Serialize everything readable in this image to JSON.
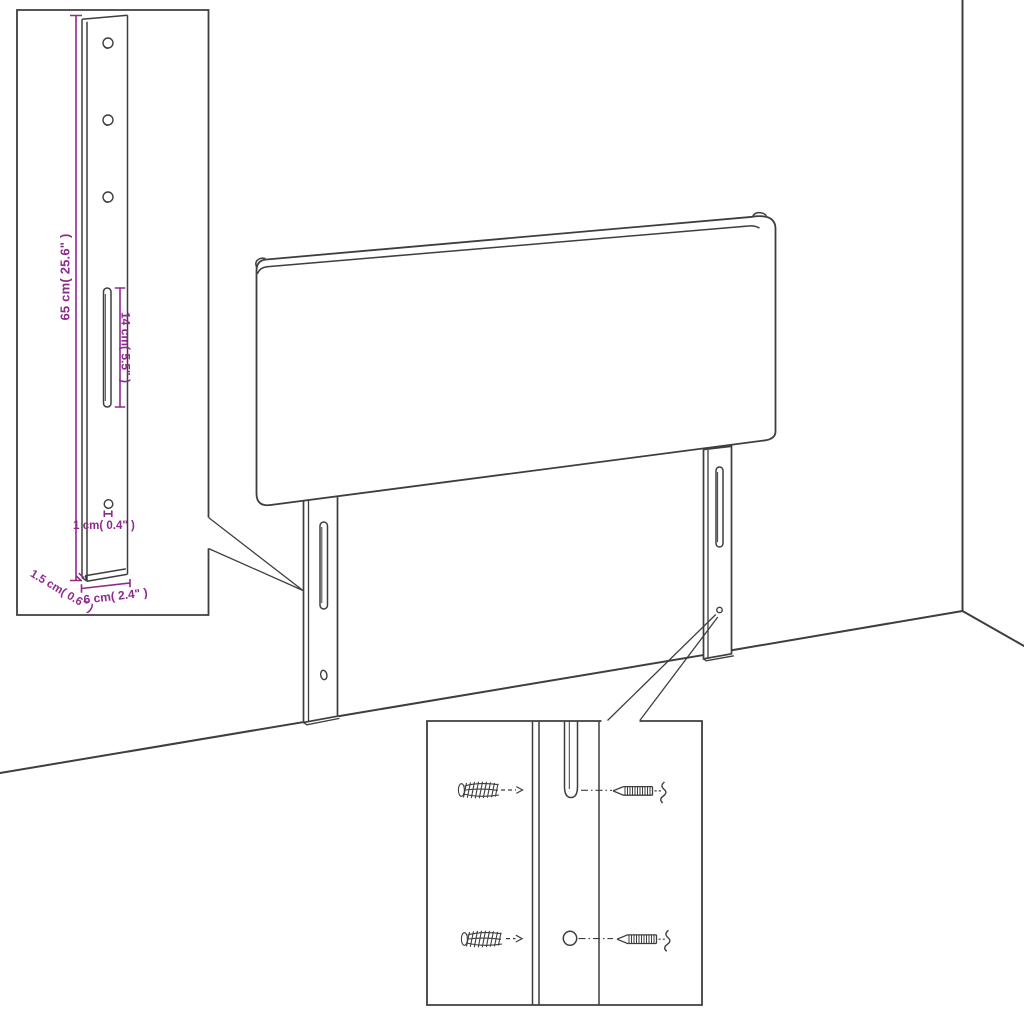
{
  "diagram": {
    "colors": {
      "background": "#ffffff",
      "line": "#3e3e3e",
      "dimension": "#8e2a8c"
    },
    "bracket_inset": {
      "height_label": "65 cm( 25.6\" )",
      "slot_length_label": "14 cm( 5.5\" )",
      "hole_diameter_label": "1 cm( 0.4\" )",
      "depth_label": "1.5 cm( 0.6\" )",
      "width_label": "6 cm( 2.4\" )"
    },
    "fastening_inset": {
      "icons": [
        "wall-plug",
        "screw",
        "leg-slot",
        "leg-hole"
      ]
    }
  }
}
